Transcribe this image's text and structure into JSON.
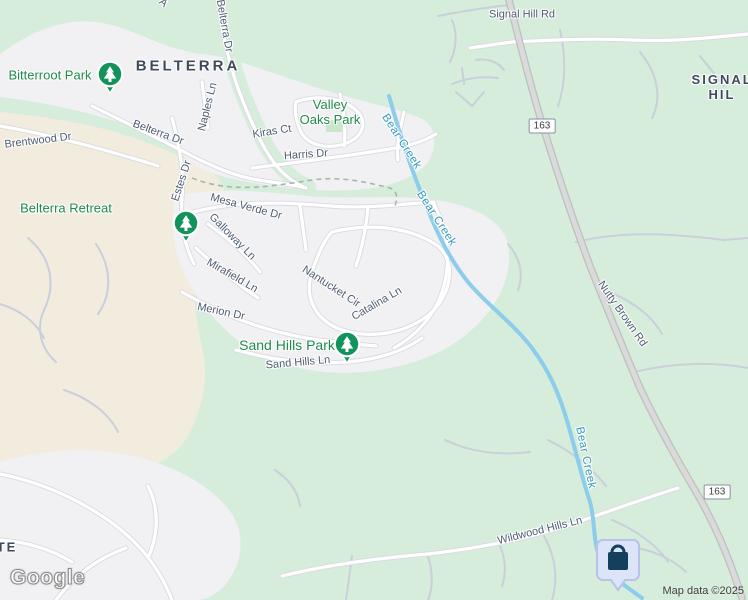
{
  "map": {
    "logo": "Google",
    "attribution": "Map data ©2025",
    "labels": [
      {
        "name": "street-label-signal-hill-rd",
        "type": "street",
        "text": "Signal Hill Rd",
        "x": 522,
        "y": 15,
        "rot": 0
      },
      {
        "name": "street-label-nutty-brown-rd",
        "type": "street",
        "text": "Nutty Brown Rd",
        "x": 622,
        "y": 314,
        "rot": 55
      },
      {
        "name": "street-label-belterra-dr-north",
        "type": "street",
        "text": "Belterra Dr",
        "x": 224,
        "y": 26,
        "rot": 80
      },
      {
        "name": "street-label-partial-top",
        "type": "street",
        "text": "A",
        "x": 163,
        "y": 3,
        "rot": 40
      },
      {
        "name": "street-label-naples-ln",
        "type": "street",
        "text": "Naples Ln",
        "x": 208,
        "y": 107,
        "rot": -76
      },
      {
        "name": "street-label-belterra-dr-west",
        "type": "street",
        "text": "Belterra Dr",
        "x": 158,
        "y": 133,
        "rot": 20
      },
      {
        "name": "street-label-brentwood-dr",
        "type": "street",
        "text": "Brentwood Dr",
        "x": 38,
        "y": 141,
        "rot": -7
      },
      {
        "name": "street-label-estes-dr",
        "type": "street",
        "text": "Estes Dr",
        "x": 182,
        "y": 181,
        "rot": -72
      },
      {
        "name": "street-label-kiras-ct",
        "type": "street",
        "text": "Kiras Ct",
        "x": 272,
        "y": 132,
        "rot": -9
      },
      {
        "name": "street-label-harris-dr",
        "type": "street",
        "text": "Harris Dr",
        "x": 306,
        "y": 155,
        "rot": -4
      },
      {
        "name": "street-label-mesa-verde-dr",
        "type": "street",
        "text": "Mesa Verde Dr",
        "x": 246,
        "y": 207,
        "rot": 15
      },
      {
        "name": "street-label-galloway-ln",
        "type": "street",
        "text": "Galloway Ln",
        "x": 232,
        "y": 237,
        "rot": 45
      },
      {
        "name": "street-label-mirafield-ln",
        "type": "street",
        "text": "Mirafield Ln",
        "x": 232,
        "y": 276,
        "rot": 30
      },
      {
        "name": "street-label-merion-dr",
        "type": "street",
        "text": "Merion Dr",
        "x": 221,
        "y": 312,
        "rot": 12
      },
      {
        "name": "street-label-nantucket-cir",
        "type": "street",
        "text": "Nantucket Cir",
        "x": 331,
        "y": 287,
        "rot": 33
      },
      {
        "name": "street-label-catalina-ln",
        "type": "street",
        "text": "Catalina Ln",
        "x": 377,
        "y": 304,
        "rot": -30
      },
      {
        "name": "street-label-sand-hills-ln",
        "type": "street",
        "text": "Sand Hills Ln",
        "x": 298,
        "y": 363,
        "rot": -5
      },
      {
        "name": "street-label-wildwood-hills-ln",
        "type": "street",
        "text": "Wildwood Hills Ln",
        "x": 540,
        "y": 531,
        "rot": -14
      },
      {
        "name": "water-label-bear-creek-1",
        "type": "water",
        "text": "Bear Creek",
        "x": 401,
        "y": 142,
        "rot": 57
      },
      {
        "name": "water-label-bear-creek-2",
        "type": "water",
        "text": "Bear Creek",
        "x": 436,
        "y": 219,
        "rot": 57
      },
      {
        "name": "water-label-bear-creek-3",
        "type": "water",
        "text": "Bear Creek",
        "x": 585,
        "y": 458,
        "rot": 78
      },
      {
        "name": "neighborhood-label-belterra",
        "type": "hood",
        "text": "BELTERRA",
        "x": 188,
        "y": 66,
        "rot": 0,
        "size": 15,
        "ls": 3
      },
      {
        "name": "neighborhood-label-signal-hill",
        "type": "hood",
        "text": "SIGNAL HIL",
        "x": 722,
        "y": 88,
        "rot": 0,
        "size": 13,
        "ls": 2
      },
      {
        "name": "neighborhood-label-partial-te",
        "type": "hood",
        "text": "TE",
        "x": 7,
        "y": 548,
        "rot": 0,
        "size": 13,
        "ls": 2
      },
      {
        "name": "park-label-bitterroot-park",
        "type": "park",
        "text": "Bitterroot Park",
        "x": 50,
        "y": 76,
        "rot": 0
      },
      {
        "name": "park-label-valley-oaks-park",
        "type": "park",
        "text": "Valley\nOaks Park",
        "x": 330,
        "y": 113,
        "rot": 0
      },
      {
        "name": "park-label-belterra-retreat",
        "type": "park",
        "text": "Belterra Retreat",
        "x": 66,
        "y": 209,
        "rot": 0
      },
      {
        "name": "park-label-sand-hills-park",
        "type": "park",
        "text": "Sand Hills Park",
        "x": 287,
        "y": 345,
        "rot": 0,
        "size": 14
      }
    ],
    "route_badges": [
      {
        "name": "route-badge-163-north",
        "text": "163",
        "x": 542,
        "y": 126
      },
      {
        "name": "route-badge-163-south",
        "text": "163",
        "x": 717,
        "y": 492
      }
    ],
    "markers": [
      {
        "name": "park-marker-bitterroot-park",
        "type": "tree",
        "x": 110,
        "y": 74
      },
      {
        "name": "park-marker-belterra-retreat",
        "type": "tree",
        "x": 186,
        "y": 223
      },
      {
        "name": "park-marker-sand-hills-park",
        "type": "tree",
        "x": 347,
        "y": 344
      },
      {
        "name": "poi-marker-shopping",
        "type": "shopping",
        "x": 618,
        "y": 560
      }
    ],
    "colors": {
      "vegetation": "#d5edda",
      "residential": "#f1f0f3",
      "suburb_beige": "#f1ecdd",
      "road_white": "#ffffff",
      "highway": "#dadada",
      "water": "#8ccdeb",
      "water_label": "#379cc0",
      "street_label": "#4e5d73",
      "district_label": "#3e4a5c",
      "park_label": "#1f8a4c",
      "park_marker": "#12935c",
      "poi_pin_fill": "#dbe4f8",
      "poi_pin_glyph": "#14405e"
    }
  }
}
